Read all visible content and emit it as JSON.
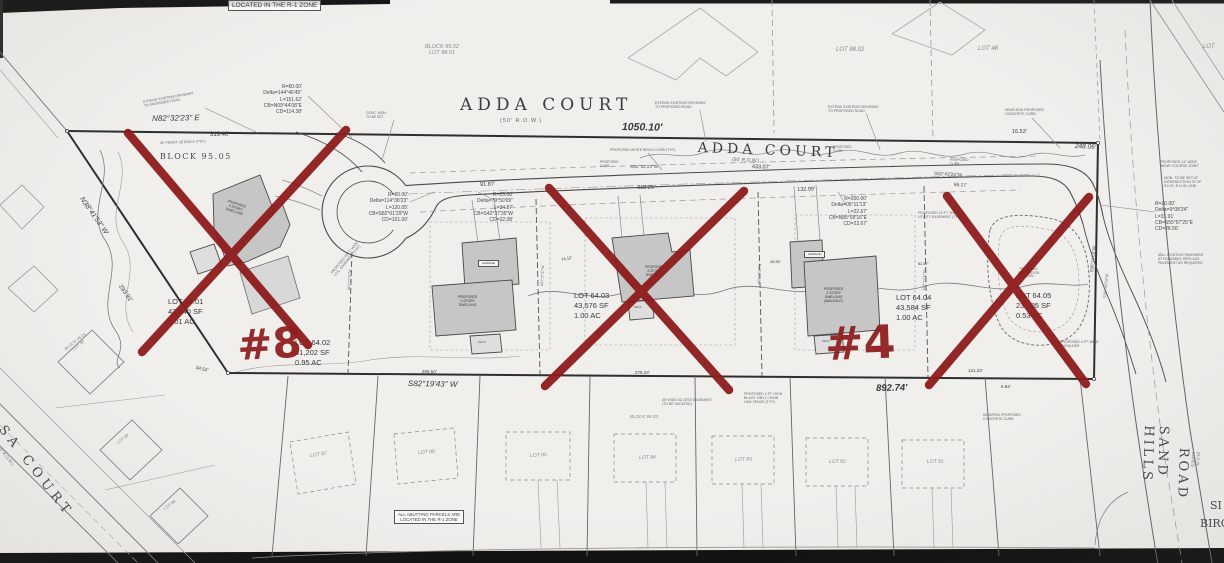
{
  "colors": {
    "red_annotation": "#8e1c1c",
    "paper": "#f1efec",
    "ink": "#3a3a3a"
  },
  "red_marks": {
    "left": "#8",
    "right": "#4",
    "crossed_lots": [
      "LOT 64.01",
      "LOT 64.03",
      "LOT 64.05"
    ]
  },
  "labels": [
    {
      "n": "zone-box",
      "t": "LOCATED IN THE R-1 ZONE",
      "x": 228,
      "y": 0,
      "fs": 6.5,
      "box": 1
    },
    {
      "n": "adj-lot-8801",
      "t": "BLOCK 95.02\nLOT 88.01",
      "x": 425,
      "y": 44,
      "fs": 5.5,
      "it": 1,
      "c": "#8a8a8a",
      "ta": "center"
    },
    {
      "n": "adj-lot-8802",
      "t": "LOT 88.02",
      "x": 836,
      "y": 47,
      "fs": 6,
      "it": 1,
      "c": "#8a8a8a"
    },
    {
      "n": "adj-lot-48",
      "t": "LOT 48",
      "x": 978,
      "y": 46,
      "fs": 6,
      "it": 1,
      "c": "#8a8a8a"
    },
    {
      "n": "adj-lot-right",
      "t": "LOT",
      "x": 1203,
      "y": 44,
      "fs": 6,
      "it": 1,
      "c": "#8a8a8a"
    },
    {
      "n": "adda-court-1",
      "t": "ADDA COURT",
      "x": 460,
      "y": 96,
      "fs": 17,
      "serif": 1,
      "ls": 5,
      "c": "#3d3d3d"
    },
    {
      "n": "adda-court-1-row",
      "t": "(50' R.O.W.)",
      "x": 500,
      "y": 118,
      "fs": 5.5,
      "c": "#666",
      "ls": 1
    },
    {
      "n": "dim-1050",
      "t": "1050.10'",
      "x": 622,
      "y": 121,
      "fs": 10.5,
      "it": 1,
      "w": 600,
      "rot": 1
    },
    {
      "n": "adda-court-2",
      "t": "ADDA COURT",
      "x": 698,
      "y": 140,
      "fs": 14,
      "serif": 1,
      "ls": 4,
      "rot": 2,
      "c": "#3d3d3d"
    },
    {
      "n": "adda-court-2-row",
      "t": "(50' R.O.W.)",
      "x": 732,
      "y": 158,
      "fs": 5,
      "c": "#666",
      "rot": 2
    },
    {
      "n": "dim-43307",
      "t": "433.07'",
      "x": 752,
      "y": 164,
      "fs": 5.5,
      "rot": 2
    },
    {
      "n": "brg-n82",
      "t": "N82°32'23\" E",
      "x": 152,
      "y": 114,
      "fs": 8,
      "it": 1,
      "rot": -1
    },
    {
      "n": "dim-31940",
      "t": "319.40'",
      "x": 210,
      "y": 132,
      "fs": 6
    },
    {
      "n": "curve-1",
      "t": "R=60.00'\nDelta=144°46'45\"\nL=151.62'\nCB=N09°44'08\"E\nCD=114.38'",
      "x": 240,
      "y": 84,
      "fs": 5,
      "ta": "right",
      "wd": 62,
      "lh": 1.25,
      "c": "#4a4a4a"
    },
    {
      "n": "curve-2",
      "t": "R=60.00'\nDelta=114°38'23\"\nL=120.05'\nCB=S82°01'29\"W\nCD=101.00'",
      "x": 350,
      "y": 192,
      "fs": 5,
      "ta": "right",
      "wd": 58,
      "lh": 1.25,
      "c": "#4a4a4a"
    },
    {
      "n": "curve-3",
      "t": "R=25.00'\nDelta=79°50'09\"\nL=34.87'\nCB=S42°37'35\"W\nCD=32.08'",
      "x": 458,
      "y": 192,
      "fs": 5,
      "ta": "right",
      "wd": 55,
      "lh": 1.25,
      "c": "#4a4a4a"
    },
    {
      "n": "dim-9187",
      "t": "91.87'",
      "x": 480,
      "y": 182,
      "fs": 5.5,
      "rot": -2
    },
    {
      "n": "curve-4",
      "t": "R=200.00'\nDelta=05°11'13\"\nL=22.67'\nCB=N85°09'16\"E\nCD=22.67'",
      "x": 812,
      "y": 196,
      "fs": 5,
      "ta": "right",
      "wd": 55,
      "lh": 1.25,
      "c": "#4a4a4a"
    },
    {
      "n": "dim-13299",
      "t": "132.99'",
      "x": 797,
      "y": 187,
      "fs": 5.5,
      "rot": -2
    },
    {
      "n": "dim-31825",
      "t": "318.25'",
      "x": 637,
      "y": 185,
      "fs": 5.5,
      "rot": -1
    },
    {
      "n": "brg-s82-32",
      "t": "S82°32'23\"W",
      "x": 630,
      "y": 165,
      "fs": 4.8,
      "c": "#555"
    },
    {
      "n": "brg-s82-43",
      "t": "S82°43'26\"W",
      "x": 934,
      "y": 172,
      "fs": 4.8,
      "rot": 3,
      "c": "#555"
    },
    {
      "n": "dim-6517",
      "t": "65.17'",
      "x": 954,
      "y": 183,
      "fs": 4.8,
      "rot": 3
    },
    {
      "n": "dim-1653",
      "t": "16.53'",
      "x": 1012,
      "y": 129,
      "fs": 5.5
    },
    {
      "n": "dim-24806",
      "t": "248.06'",
      "x": 1075,
      "y": 143,
      "fs": 6.5,
      "it": 1,
      "rot": 2
    },
    {
      "n": "curve-5",
      "t": "R=20.00'\nDelta=9°08'24\"\nL=31.91'\nCB=S55°57'25\"E\nCD=28.56'",
      "x": 1155,
      "y": 201,
      "fs": 5,
      "lh": 1.25,
      "c": "#4a4a4a"
    },
    {
      "n": "note-joint",
      "t": "PROPOSED 24\" WIDE\nWEAR COURSE JOINT",
      "x": 1160,
      "y": 160,
      "fs": 3.6,
      "c": "#666"
    },
    {
      "n": "note-mon",
      "t": "MON. TO BE SET AT\nINTERSECTION 'B' OF\nS.H.R. R.O.W. LINE",
      "x": 1164,
      "y": 176,
      "fs": 3.6,
      "c": "#666"
    },
    {
      "n": "note-mill",
      "t": "MILL EXISTING PAVEMENT\nAT ROADWAY. REPLACE\nPAVEMENT AS REQUIRED",
      "x": 1158,
      "y": 253,
      "fs": 3.6,
      "c": "#666"
    },
    {
      "n": "brg-s06-1",
      "t": "S06°19'03\"W",
      "x": 1089,
      "y": 272,
      "fs": 4.5,
      "rot": -84,
      "c": "#555"
    },
    {
      "n": "brg-s06-2",
      "t": "S06°19'03\"W",
      "x": 1103,
      "y": 298,
      "fs": 4.2,
      "rot": -84,
      "c": "#777"
    },
    {
      "n": "lot-1-label",
      "t": "LOT 64.01\n43,940 SF\n1.01 AC",
      "x": 168,
      "y": 297,
      "fs": 7.5,
      "lh": 1.3
    },
    {
      "n": "lot-2-label",
      "t": "LOT 64.02\n41,202 SF\n0.95 AC",
      "x": 295,
      "y": 338,
      "fs": 7.5,
      "lh": 1.3
    },
    {
      "n": "lot-3-label",
      "t": "LOT 64.03\n43,576 SF\n1.00 AC",
      "x": 574,
      "y": 291,
      "fs": 7.5,
      "lh": 1.3
    },
    {
      "n": "lot-4-label",
      "t": "LOT 64.04\n43,584 SF\n1.00 AC",
      "x": 896,
      "y": 293,
      "fs": 7.5,
      "lh": 1.3
    },
    {
      "n": "lot-5-label",
      "t": "LOT 64.05\n23,105 SF\n0.53 AC",
      "x": 1016,
      "y": 291,
      "fs": 7.5,
      "lh": 1.3
    },
    {
      "n": "block-9505",
      "t": "BLOCK 95.05",
      "x": 160,
      "y": 152,
      "fs": 8,
      "serif": 1,
      "ls": 1.5,
      "c": "#4a4a4a"
    },
    {
      "n": "brg-n38",
      "t": "N38°41'53\" W",
      "x": 84,
      "y": 196,
      "fs": 7,
      "it": 1,
      "rot": 55
    },
    {
      "n": "dim-29391",
      "t": "293.91'",
      "x": 122,
      "y": 284,
      "fs": 6,
      "rot": 55
    },
    {
      "n": "brg-s8219",
      "t": "S82°19'43\" W",
      "x": 408,
      "y": 379,
      "fs": 8,
      "it": 1,
      "rot": 1
    },
    {
      "n": "dim-89274",
      "t": "892.74'",
      "x": 876,
      "y": 384,
      "fs": 9.5,
      "it": 1,
      "w": 600,
      "rot": -1
    },
    {
      "n": "dim-3452",
      "t": "34.52'",
      "x": 196,
      "y": 366,
      "fs": 4.8,
      "rot": 12
    },
    {
      "n": "dim-29550",
      "t": "295.50'",
      "x": 422,
      "y": 369,
      "fs": 4.5,
      "rot": 1
    },
    {
      "n": "dim-27823",
      "t": "278.23'",
      "x": 635,
      "y": 370,
      "fs": 4.5
    },
    {
      "n": "dim-12123",
      "t": "121.23'",
      "x": 968,
      "y": 368,
      "fs": 4.5
    },
    {
      "n": "dim-694",
      "t": "6.94'",
      "x": 1001,
      "y": 384,
      "fs": 4.5
    },
    {
      "n": "block-9503",
      "t": "BLOCK 95.03",
      "x": 630,
      "y": 414,
      "fs": 4.5,
      "it": 1,
      "c": "#8a8a8a"
    },
    {
      "n": "bottom-lot-87",
      "t": "LOT 87",
      "x": 310,
      "y": 454,
      "fs": 5,
      "it": 1,
      "c": "#8a8a8a",
      "rot": -8
    },
    {
      "n": "bottom-lot-86",
      "t": "LOT 86",
      "x": 418,
      "y": 451,
      "fs": 5,
      "it": 1,
      "c": "#8a8a8a",
      "rot": -4
    },
    {
      "n": "bottom-lot-85",
      "t": "LOT 85",
      "x": 530,
      "y": 454,
      "fs": 5,
      "it": 1,
      "c": "#8a8a8a",
      "rot": -3
    },
    {
      "n": "bottom-lot-84",
      "t": "LOT 84",
      "x": 639,
      "y": 456,
      "fs": 5,
      "it": 1,
      "c": "#8a8a8a",
      "rot": -2
    },
    {
      "n": "bottom-lot-83",
      "t": "LOT 83",
      "x": 735,
      "y": 458,
      "fs": 5,
      "it": 1,
      "c": "#8a8a8a",
      "rot": -2
    },
    {
      "n": "bottom-lot-82",
      "t": "LOT 82",
      "x": 829,
      "y": 460,
      "fs": 5,
      "it": 1,
      "c": "#8a8a8a",
      "rot": -1
    },
    {
      "n": "bottom-lot-81",
      "t": "LOT 81",
      "x": 927,
      "y": 460,
      "fs": 5,
      "it": 1,
      "c": "#8a8a8a",
      "rot": -1
    },
    {
      "n": "left-lot-90",
      "t": "BLOCK 95.01\nLOT 90",
      "x": 64,
      "y": 348,
      "fs": 4.2,
      "rot": -38,
      "it": 1,
      "c": "#8a8a8a",
      "ta": "center"
    },
    {
      "n": "left-lot-89",
      "t": "LOT 89",
      "x": 116,
      "y": 442,
      "fs": 4.2,
      "rot": -38,
      "it": 1,
      "c": "#8a8a8a"
    },
    {
      "n": "left-lot-88",
      "t": "LOT 88",
      "x": 163,
      "y": 508,
      "fs": 4.2,
      "rot": -38,
      "it": 1,
      "c": "#8a8a8a"
    },
    {
      "n": "ulsa-court",
      "t": "ULSA COURT",
      "x": -12,
      "y": 400,
      "fs": 13,
      "serif": 1,
      "ls": 5,
      "rot": 52,
      "c": "#4a4a4a"
    },
    {
      "n": "ulsa-court-row",
      "t": "(50' R.O.W.)",
      "x": 0,
      "y": 444,
      "fs": 4.5,
      "rot": 52,
      "c": "#777"
    },
    {
      "n": "sand-hills-road",
      "t": "SAND HILLS",
      "x": 1170,
      "y": 426,
      "fs": 13,
      "serif": 1,
      "ls": 3,
      "rot": 92,
      "c": "#4a4a4a"
    },
    {
      "n": "sand-hills-road-2",
      "t": "ROAD",
      "x": 1190,
      "y": 448,
      "fs": 13,
      "serif": 1,
      "ls": 3,
      "rot": 92,
      "c": "#4a4a4a"
    },
    {
      "n": "sand-hills-row",
      "t": "(R.O.W. VARIES)",
      "x": 1200,
      "y": 452,
      "fs": 4,
      "rot": 92,
      "c": "#777"
    },
    {
      "n": "si-partial",
      "t": "SI",
      "x": 1210,
      "y": 500,
      "fs": 11,
      "serif": 1,
      "c": "#4a4a4a"
    },
    {
      "n": "birc-partial",
      "t": "BIRC",
      "x": 1200,
      "y": 518,
      "fs": 11,
      "serif": 1,
      "c": "#4a4a4a"
    },
    {
      "n": "abutting-box",
      "t": "ALL ABUTTING PARCELS ARE\nLOCATED IN THE R-1 ZONE",
      "x": 394,
      "y": 510,
      "fs": 4.4,
      "box": 1,
      "ta": "center",
      "c": "#444"
    },
    {
      "n": "note-extend-1",
      "t": "EXTEND EXISTING DRIVEWAY\nTO PROPOSED ROAD",
      "x": 143,
      "y": 100,
      "fs": 3.5,
      "c": "#666",
      "rot": -10
    },
    {
      "n": "note-extend-2",
      "t": "EXTEND EXISTING DRIVEWAY\nTO PROPOSED ROAD",
      "x": 655,
      "y": 101,
      "fs": 3.5,
      "c": "#666"
    },
    {
      "n": "note-extend-3",
      "t": "EXTEND EXISTING DRIVEWAY\nTO PROPOSED ROAD",
      "x": 828,
      "y": 105,
      "fs": 3.5,
      "c": "#666"
    },
    {
      "n": "note-birch-curb",
      "t": "PROPOSED WHITE BIRCH CURB (TYP.)",
      "x": 610,
      "y": 148,
      "fs": 3.5,
      "c": "#666"
    },
    {
      "n": "note-nearend",
      "t": "NEAR-END PROPOSED\nCONCRETE CURB",
      "x": 1005,
      "y": 108,
      "fs": 3.5,
      "c": "#666"
    },
    {
      "n": "note-curb-1",
      "t": "PROPOSED\nCURB",
      "x": 600,
      "y": 161,
      "fs": 3.3,
      "c": "#666"
    },
    {
      "n": "note-curb-2",
      "t": "PROPOSED\nCURB",
      "x": 833,
      "y": 146,
      "fs": 3.3,
      "c": "#666"
    },
    {
      "n": "note-curb-3",
      "t": "PROPOSED\nCURB",
      "x": 950,
      "y": 159,
      "fs": 3.3,
      "c": "#666"
    },
    {
      "n": "note-util-1",
      "t": "PROPOSED 10 FT. WIDE\nUTILITY EASEMENT (TYP.)",
      "x": 918,
      "y": 211,
      "fs": 3.5,
      "c": "#666"
    },
    {
      "n": "note-util-2",
      "t": "PROPOSED 10 FT. WIDE\nUTIL. EASEMENT (TYP.)",
      "x": 330,
      "y": 272,
      "fs": 3.5,
      "rot": -50,
      "c": "#666"
    },
    {
      "n": "note-fence",
      "t": "PROPOSED 4 FT. HIGH\nBLACK VINYL CHAIN\nLINK FENCE (TYP.)",
      "x": 744,
      "y": 392,
      "fs": 3.5,
      "c": "#666"
    },
    {
      "n": "note-access",
      "t": "40' WIDE ACCESS EASEMENT\n(TO BE VACATED)",
      "x": 662,
      "y": 398,
      "fs": 3.5,
      "c": "#666"
    },
    {
      "n": "note-setback",
      "t": "25' FRONT SETBACK (TYP.)",
      "x": 160,
      "y": 141,
      "fs": 3.5,
      "rot": -2,
      "c": "#666"
    },
    {
      "n": "note-shoulder",
      "t": "PROPOSED 4 FT. WIDE\nSHOULDER",
      "x": 1060,
      "y": 340,
      "fs": 3.5,
      "c": "#666"
    },
    {
      "n": "note-modcurb",
      "t": "MODIFIED PROPOSED\nCONCRETE CURB",
      "x": 983,
      "y": 413,
      "fs": 3.5,
      "c": "#666"
    },
    {
      "n": "note-mon2",
      "t": "CONC. MON.\nTO BE SET",
      "x": 366,
      "y": 112,
      "fs": 3.4,
      "c": "#666"
    },
    {
      "n": "house-1-label",
      "t": "PROPOSED\n2-STORY\nDWELLING",
      "x": 228,
      "y": 200,
      "fs": 3.4,
      "rot": 18,
      "c": "#333",
      "ta": "center"
    },
    {
      "n": "house-2-label",
      "t": "PROPOSED\n2-STORY\nDWELLING",
      "x": 458,
      "y": 296,
      "fs": 3.4,
      "c": "#333",
      "ta": "center"
    },
    {
      "n": "house-3-label",
      "t": "PROPOSED\n2-STORY\nDWELLING",
      "x": 645,
      "y": 266,
      "fs": 3.4,
      "c": "#333",
      "ta": "center"
    },
    {
      "n": "house-4-label",
      "t": "PROPOSED\n2-STORY\nDWELLING\n(WALKOUT)",
      "x": 824,
      "y": 288,
      "fs": 3.4,
      "c": "#333",
      "ta": "center"
    },
    {
      "n": "garage-2-label",
      "t": "GARAGE",
      "x": 478,
      "y": 260,
      "fs": 3,
      "c": "#333",
      "box": 1
    },
    {
      "n": "garage-4-label",
      "t": "GARAGE",
      "x": 804,
      "y": 251,
      "fs": 3,
      "c": "#333",
      "box": 1
    },
    {
      "n": "deck-2-label",
      "t": "DECK",
      "x": 478,
      "y": 341,
      "fs": 2.8,
      "c": "#555"
    },
    {
      "n": "deck-3-label",
      "t": "DECK",
      "x": 634,
      "y": 306,
      "fs": 2.8,
      "c": "#555"
    },
    {
      "n": "deck-4-label",
      "t": "DECK",
      "x": 822,
      "y": 340,
      "fs": 2.8,
      "c": "#555"
    },
    {
      "n": "basin-label",
      "t": "PROPOSED\nINFILTRATION\nBASIN",
      "x": 1018,
      "y": 268,
      "fs": 3.2,
      "c": "#666",
      "ta": "center"
    },
    {
      "n": "brg-n0727-1",
      "t": "N07°27'37\"W",
      "x": 347,
      "y": 290,
      "fs": 3.5,
      "rot": -87,
      "c": "#666"
    },
    {
      "n": "brg-n0727-2",
      "t": "N07°27'37\"W",
      "x": 540,
      "y": 286,
      "fs": 3.5,
      "rot": -87,
      "c": "#666"
    },
    {
      "n": "brg-n0727-3",
      "t": "N07°27'37\"W",
      "x": 757,
      "y": 284,
      "fs": 3.5,
      "rot": -87,
      "c": "#666"
    },
    {
      "n": "brg-n0727-4",
      "t": "N07°27'37\"W",
      "x": 922,
      "y": 290,
      "fs": 3.5,
      "rot": -87,
      "c": "#666"
    },
    {
      "n": "dim-7412",
      "t": "74.12'",
      "x": 561,
      "y": 258,
      "fs": 4,
      "rot": -12
    },
    {
      "n": "dim-4550",
      "t": "45.50'",
      "x": 770,
      "y": 260,
      "fs": 4
    },
    {
      "n": "dim-6267",
      "t": "62.67'",
      "x": 918,
      "y": 262,
      "fs": 4
    },
    {
      "n": "red-mark-8",
      "t": "#8",
      "x": 236,
      "y": 322,
      "fs": 42,
      "red": 1,
      "rot": -3
    },
    {
      "n": "red-mark-4",
      "t": "#4",
      "x": 824,
      "y": 318,
      "fs": 46,
      "red": 1,
      "rot": -2
    }
  ]
}
